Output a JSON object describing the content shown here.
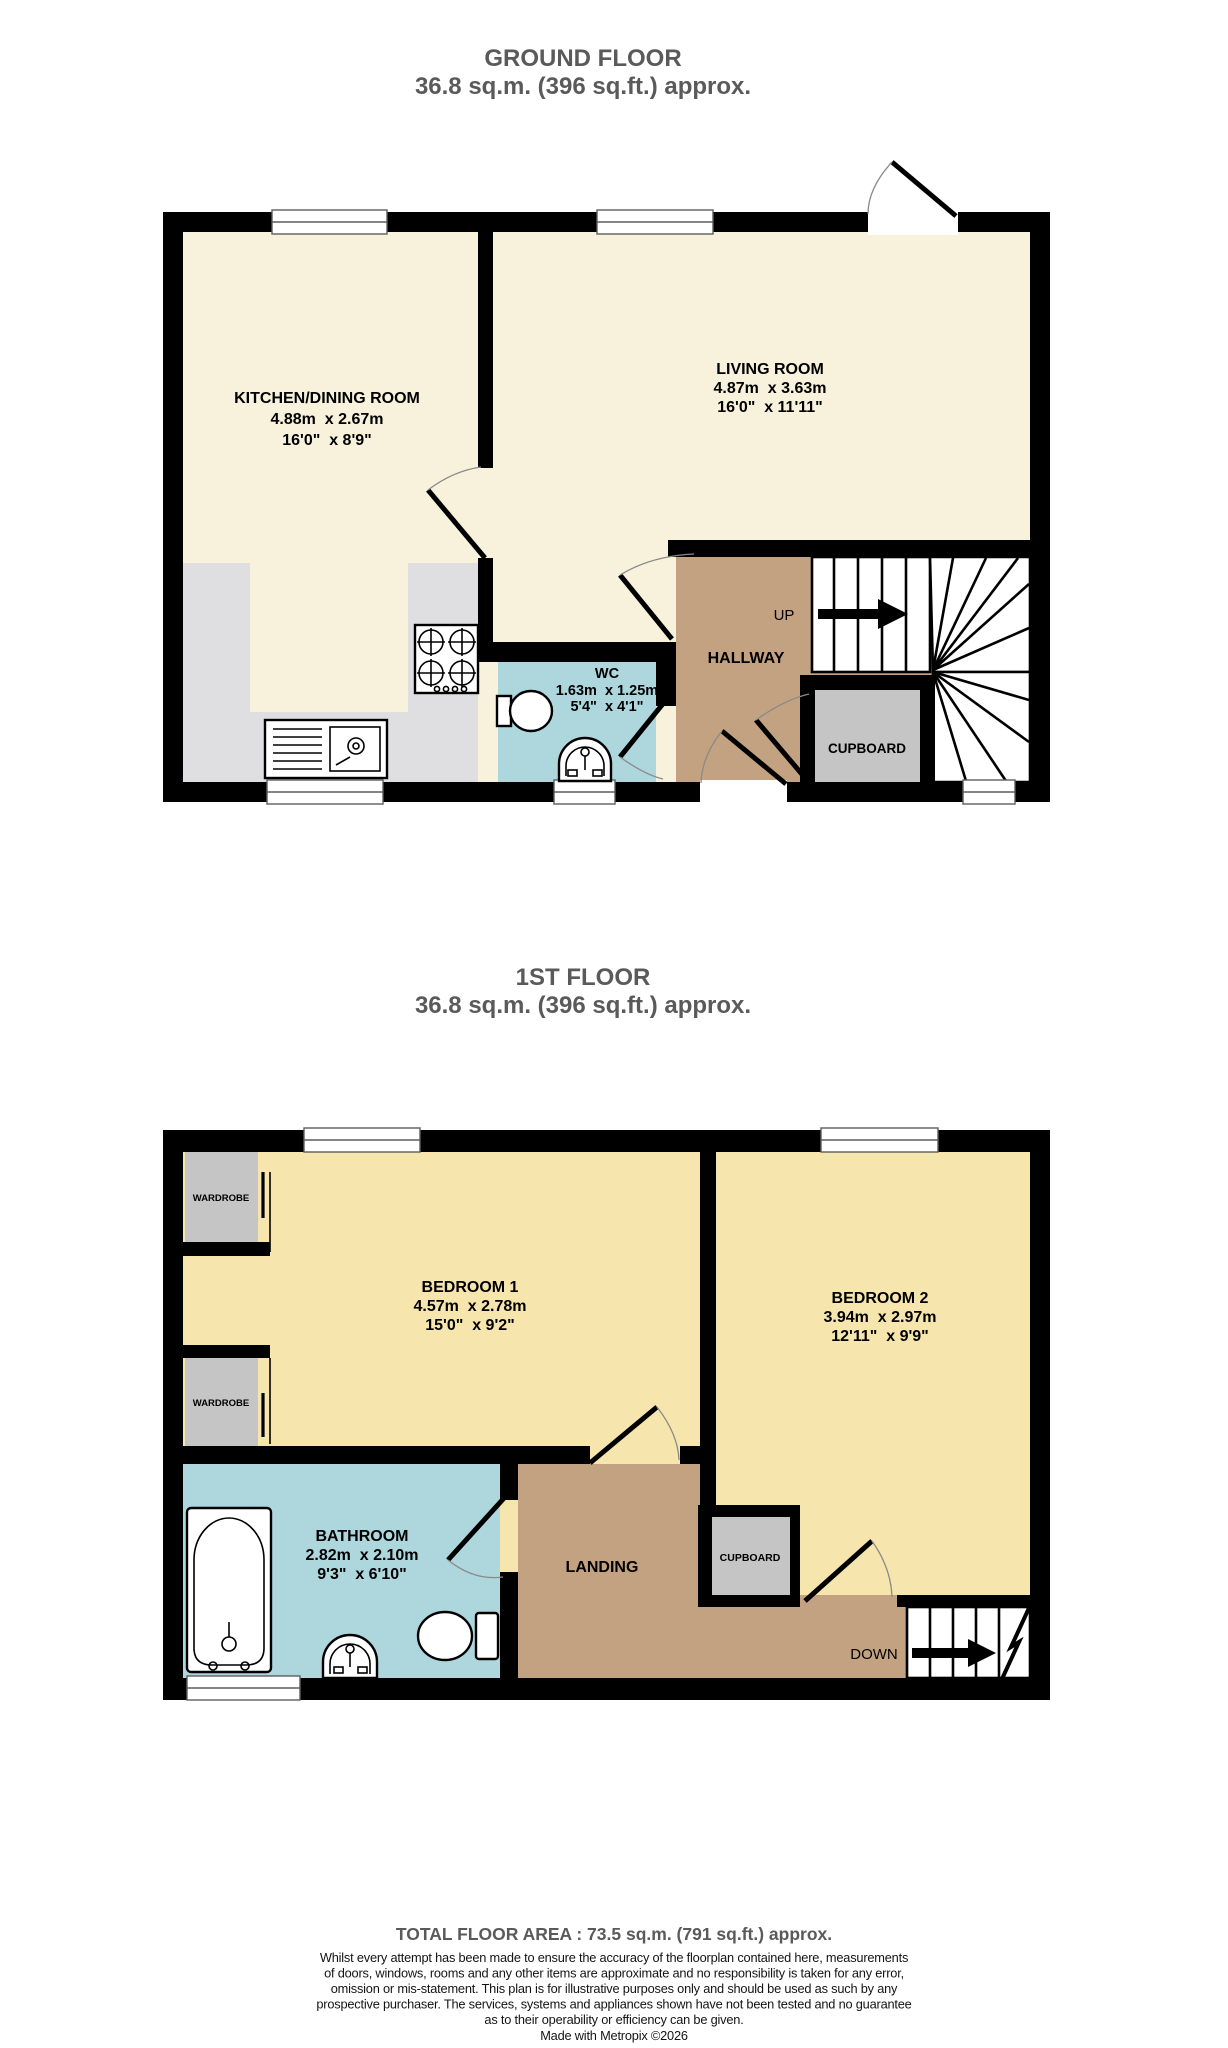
{
  "colors": {
    "wall": "#000000",
    "ground_room_cream": "#f8f2dc",
    "bedroom_yellow": "#f6e5ac",
    "hall_tan": "#c3a282",
    "wet_room_blue": "#aed6dd",
    "cupboard_gray": "#c5c5c5",
    "counter_gray": "#dfdfe1",
    "title_gray": "#5a5a5a"
  },
  "ground_floor": {
    "title": "GROUND FLOOR",
    "subtitle": "36.8 sq.m. (396 sq.ft.) approx.",
    "rooms": {
      "kitchen": {
        "name": "KITCHEN/DINING ROOM",
        "metric": "4.88m  x 2.67m",
        "imperial": "16'0\"  x 8'9\""
      },
      "living": {
        "name": "LIVING ROOM",
        "metric": "4.87m  x 3.63m",
        "imperial": "16'0\"  x 11'11\""
      },
      "wc": {
        "name": "WC",
        "metric": "1.63m  x 1.25m",
        "imperial": "5'4\"  x 4'1\""
      },
      "hallway": {
        "name": "HALLWAY"
      },
      "cupboard": {
        "name": "CUPBOARD"
      }
    },
    "stairs_label": "UP"
  },
  "first_floor": {
    "title": "1ST FLOOR",
    "subtitle": "36.8 sq.m. (396 sq.ft.) approx.",
    "rooms": {
      "bedroom1": {
        "name": "BEDROOM 1",
        "metric": "4.57m  x 2.78m",
        "imperial": "15'0\"  x 9'2\""
      },
      "bedroom2": {
        "name": "BEDROOM 2",
        "metric": "3.94m  x 2.97m",
        "imperial": "12'11\"  x 9'9\""
      },
      "bathroom": {
        "name": "BATHROOM",
        "metric": "2.82m  x 2.10m",
        "imperial": "9'3\"  x 6'10\""
      },
      "landing": {
        "name": "LANDING"
      },
      "cupboard": {
        "name": "CUPBOARD"
      },
      "wardrobe1": {
        "name": "WARDROBE"
      },
      "wardrobe2": {
        "name": "WARDROBE"
      }
    },
    "stairs_label": "DOWN"
  },
  "footer": {
    "total": "TOTAL FLOOR AREA : 73.5 sq.m. (791 sq.ft.) approx.",
    "disclaimer_lines": [
      "Whilst every attempt has been made to ensure the accuracy of the floorplan contained here, measurements",
      "of doors, windows, rooms and any other items are approximate and no responsibility is taken for any error,",
      "omission or mis-statement. This plan is for illustrative purposes only and should be used as such by any",
      "prospective purchaser. The services, systems and appliances shown have not been tested and no guarantee",
      "as to their operability or efficiency can be given.",
      "Made with Metropix ©2026"
    ]
  }
}
